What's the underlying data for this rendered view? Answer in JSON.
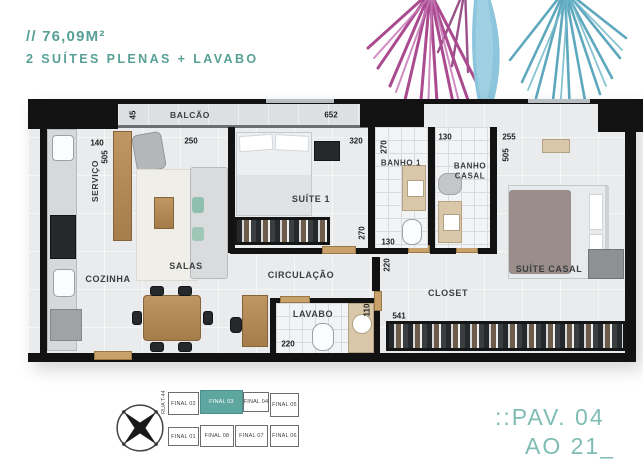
{
  "header": {
    "area": "// 76,09M²",
    "subtitle": "2 SUÍTES PLENAS + LAVABO"
  },
  "plan": {
    "rooms": {
      "balcao": "BALCÃO",
      "servico": "SERVIÇO",
      "cozinha": "COZINHA",
      "salas": "SALAS",
      "suite1": "SUÍTE 1",
      "banho1": "BANHO 1",
      "banho_casal": "BANHO CASAL",
      "suite_casal": "SUÍTE CASAL",
      "circulacao": "CIRCULAÇÃO",
      "lavabo": "LAVABO",
      "closet": "CLOSET"
    },
    "dimensions": {
      "balcao_depth": "45",
      "balcao_length": "652",
      "servico_width": "140",
      "servico_depth": "505",
      "sala_width": "250",
      "suite1_width": "320",
      "suite1_depth": "270",
      "banho1_depth": "270",
      "banho1_width": "130",
      "banho_casal_width": "130",
      "suite_casal_width": "255",
      "suite_casal_depth": "505",
      "circulacao_width": "220",
      "lavabo_width": "220",
      "lavabo_depth": "110",
      "closet_length": "541"
    }
  },
  "keyplan": {
    "street": "RUA T-44",
    "units": [
      {
        "label": "FINAL 02",
        "highlighted": false
      },
      {
        "label": "FINAL 03",
        "highlighted": true
      },
      {
        "label": "FINAL 04",
        "highlighted": false
      },
      {
        "label": "FINAL 05",
        "highlighted": false
      },
      {
        "label": "FINAL 01",
        "highlighted": false
      },
      {
        "label": "FINAL 08",
        "highlighted": false
      },
      {
        "label": "FINAL 07",
        "highlighted": false
      },
      {
        "label": "FINAL 06",
        "highlighted": false
      }
    ]
  },
  "footer": {
    "pav": "::PAV. 04",
    "ao": "AO 21_"
  },
  "colors": {
    "accent": "#57a096",
    "accent_light": "#7ebcb4",
    "highlight_unit": "#5ea6a0",
    "wall": "#121212",
    "palm_pink": "#aa4b90",
    "palm_blue": "#8cc5dc"
  }
}
